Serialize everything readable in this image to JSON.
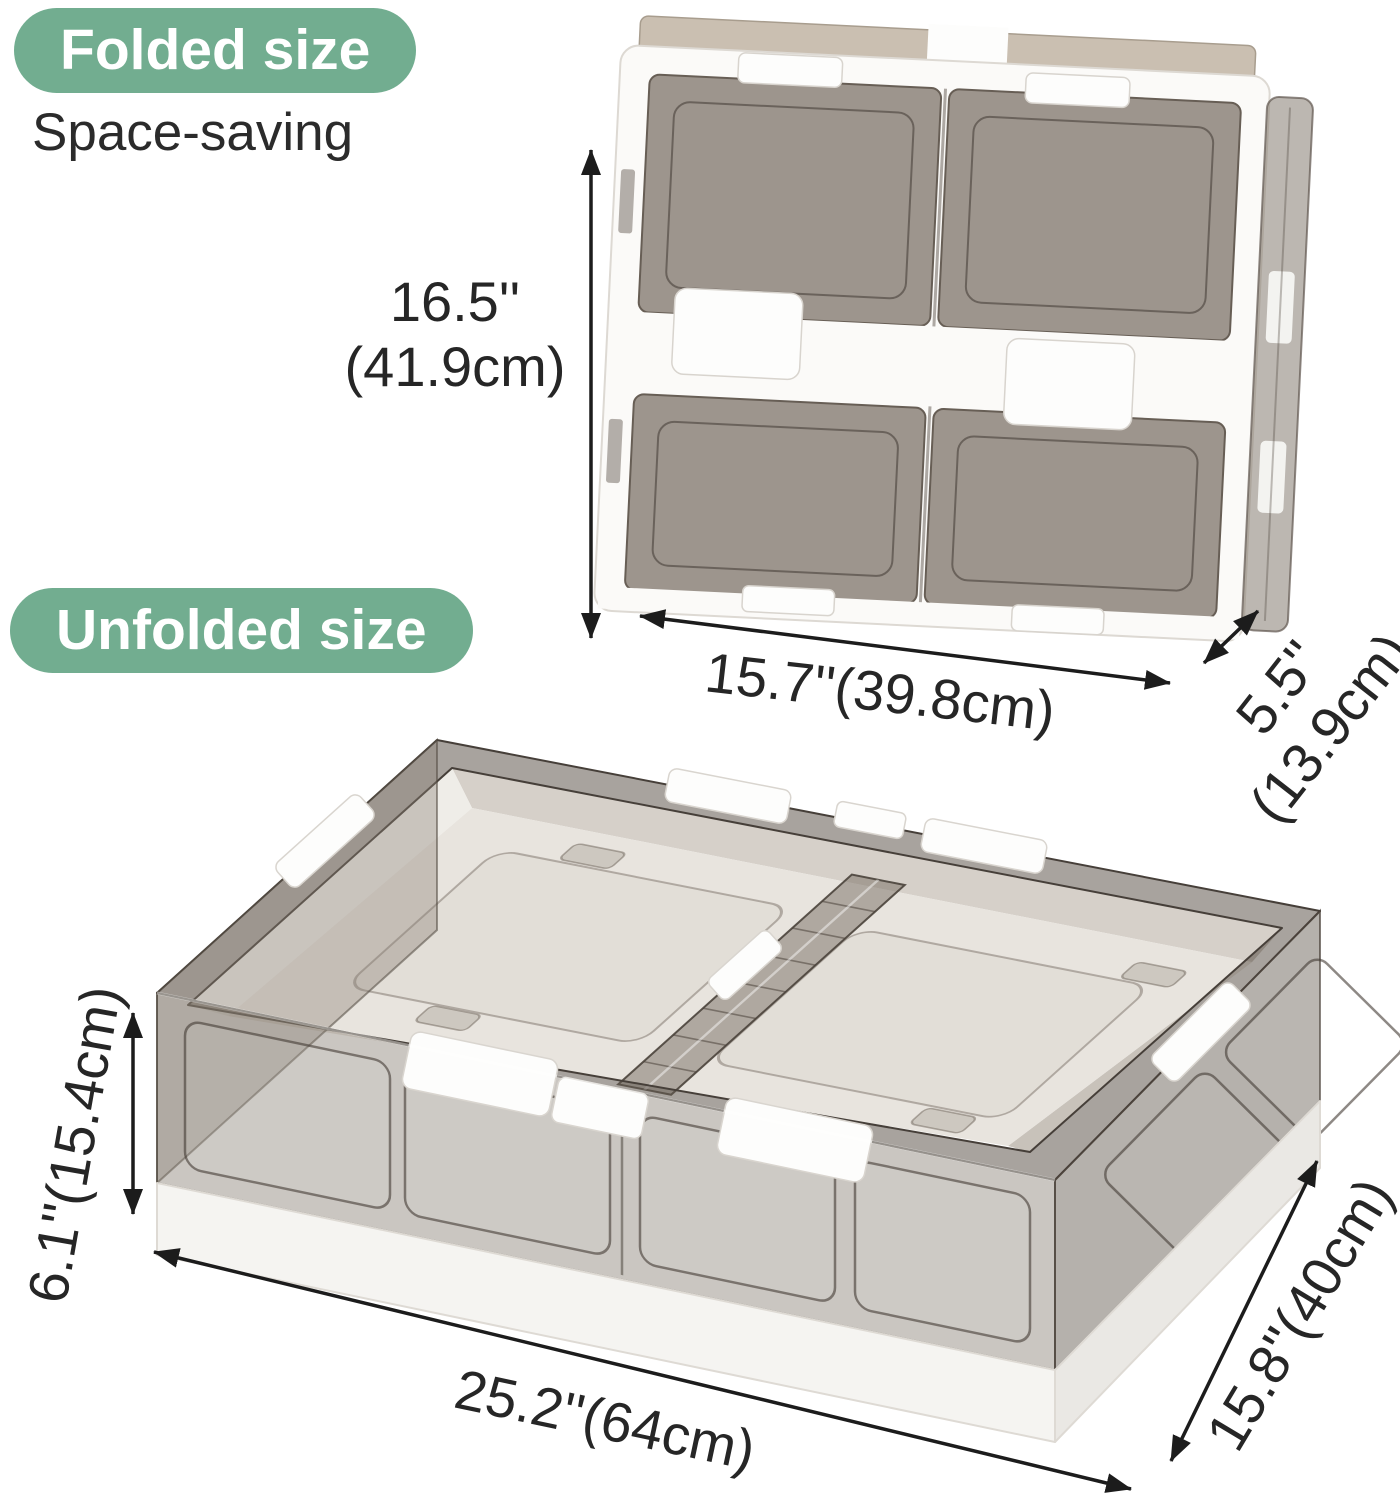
{
  "colors": {
    "badge_green": "#72ad90",
    "badge_text": "#ffffff",
    "text_dark": "#262626",
    "arrow_black": "#1c1c1c",
    "smoke_panel": "#867c72",
    "smoke_edge": "#5f564e",
    "frame_white": "#fbfaf8",
    "base_white": "#f5f4f1",
    "tan_lid": "#cabfb1",
    "floor_light": "#e8e4de"
  },
  "folded": {
    "badge": "Folded size",
    "subtitle": "Space-saving",
    "height_in": "16.5''",
    "height_cm": "(41.9cm)",
    "width": "15.7''(39.8cm)",
    "depth_in": "5.5''",
    "depth_cm": "(13.9cm)"
  },
  "unfolded": {
    "badge": "Unfolded size",
    "height": "6.1''(15.4cm)",
    "width": "25.2''(64cm)",
    "depth": "15.8''(40cm)"
  }
}
